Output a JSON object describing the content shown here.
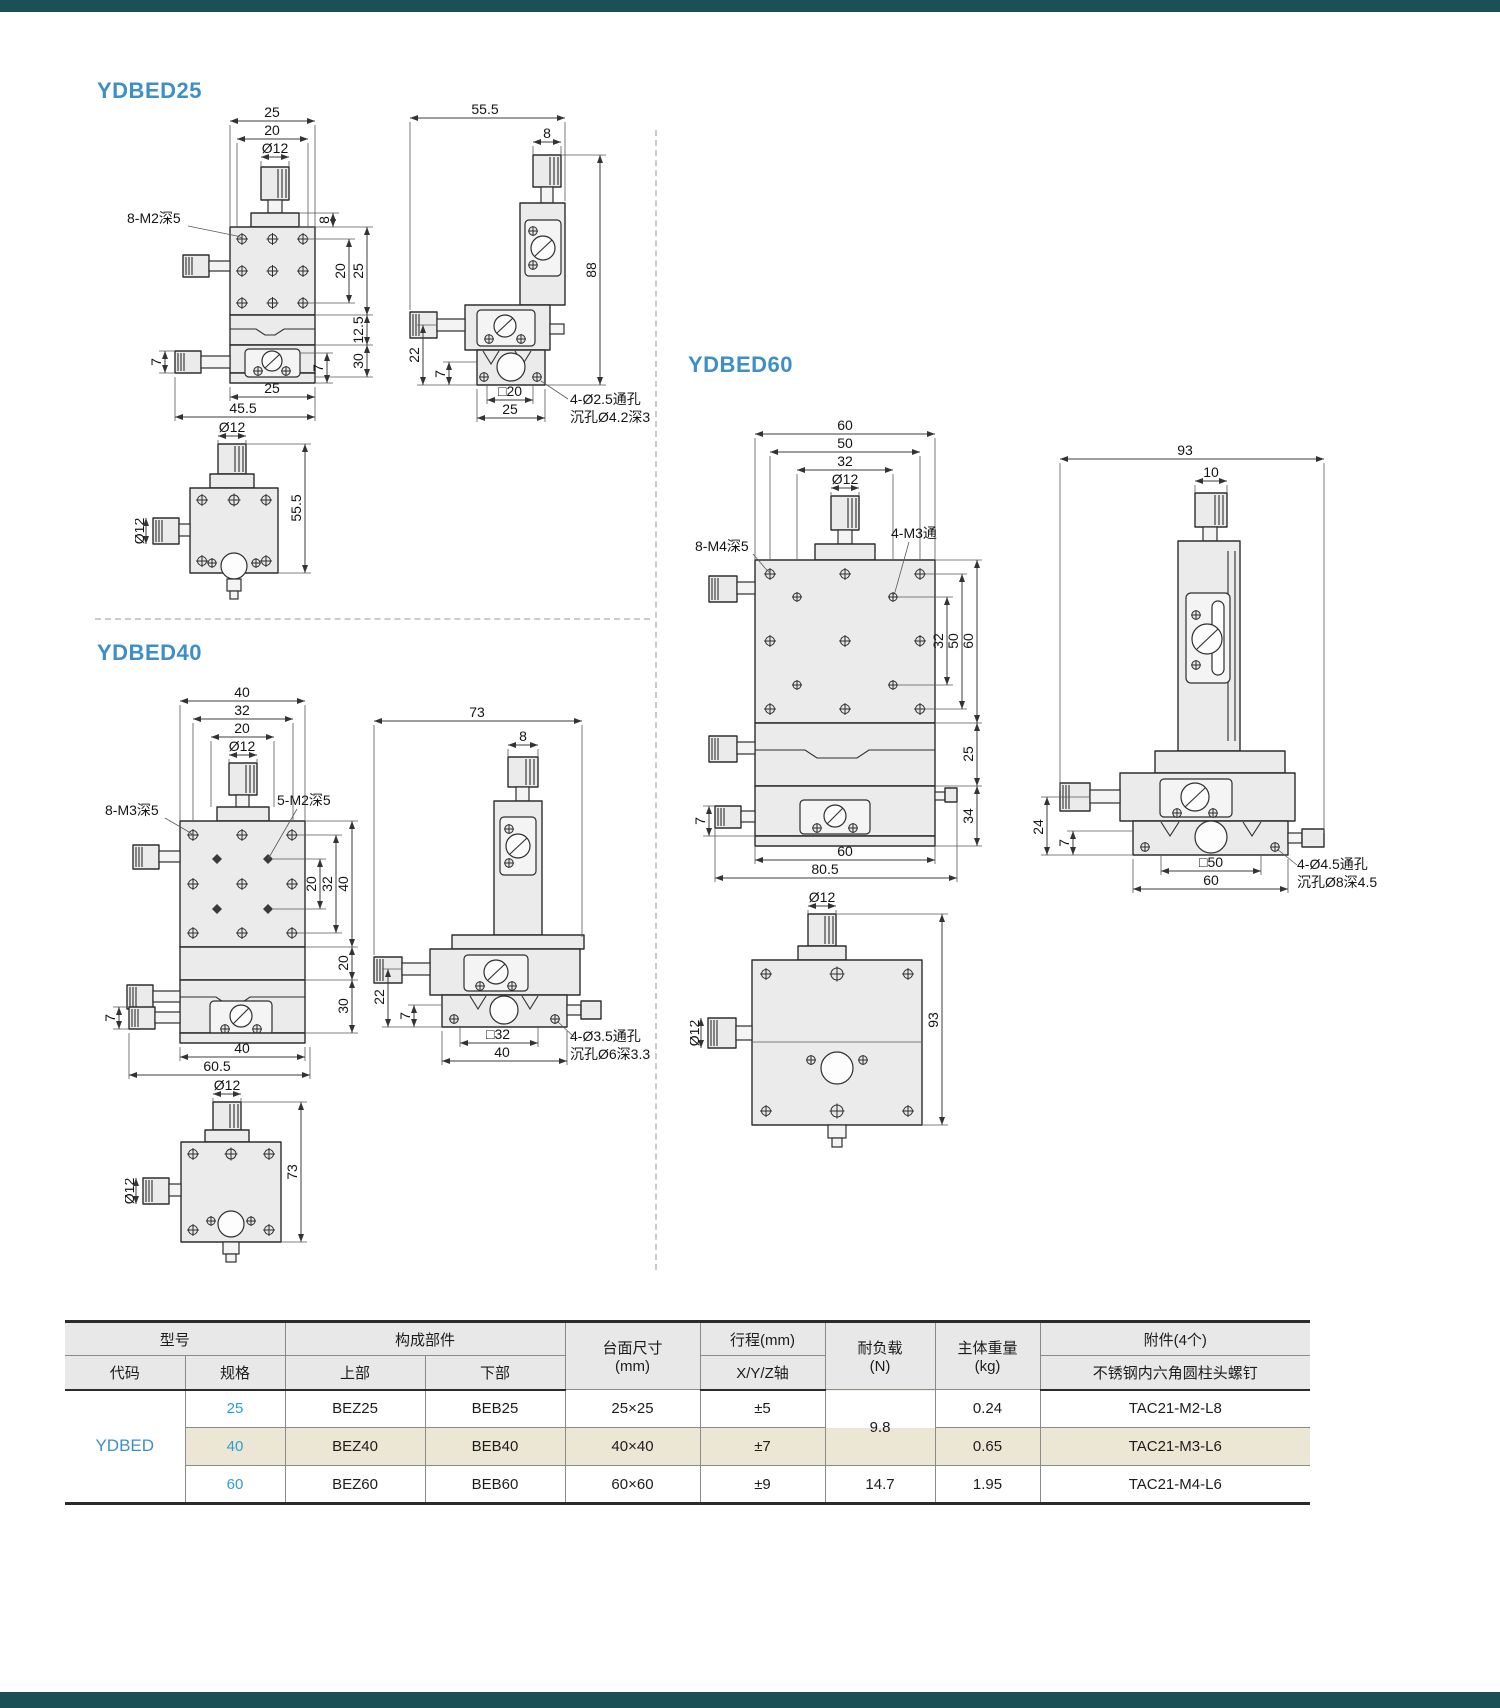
{
  "page": {
    "top_bar_color": "#1B5156",
    "bottom_bar_color": "#1B5156",
    "accent_blue": "#3E8FC7",
    "spec_blue": "#2B9FD0",
    "highlight_beige": "#ECE6D4"
  },
  "sections": {
    "d25": {
      "title": "YDBED25",
      "front": {
        "w_outer": "25",
        "w_inner": "20",
        "knob_dia": "Ø12",
        "note_thread": "8-M2深5",
        "h_collar": "8",
        "h_holes": "20",
        "h_body": "25",
        "h_mid": "12.5",
        "h_lower": "30",
        "h_knob": "7",
        "h_base": "7",
        "w_body": "25",
        "w_total": "45.5"
      },
      "side": {
        "w_total": "55.5",
        "w_knob": "8",
        "h_total": "88",
        "h_stage": "22",
        "h_plate": "7",
        "sq_base": "□20",
        "w_plate": "25",
        "note_hole1": "4-Ø2.5通孔",
        "note_hole2": "沉孔Ø4.2深3"
      },
      "top": {
        "knob_dia": "Ø12",
        "side_knob_dia": "Ø12",
        "h_total": "55.5"
      }
    },
    "d40": {
      "title": "YDBED40",
      "front": {
        "w_outer": "40",
        "w_mid": "32",
        "w_inner": "20",
        "knob_dia": "Ø12",
        "note_thread": "8-M3深5",
        "note_thread2": "5-M2深5",
        "h_inner": "20",
        "h_holes": "32",
        "h_body": "40",
        "h_mid": "20",
        "h_lower": "30",
        "h_knob": "7",
        "w_body": "40",
        "w_total": "60.5"
      },
      "side": {
        "w_total": "73",
        "w_knob": "8",
        "h_stage": "22",
        "h_plate": "7",
        "sq_base": "□32",
        "w_plate": "40",
        "note_hole1": "4-Ø3.5通孔",
        "note_hole2": "沉孔Ø6深3.3"
      },
      "top": {
        "knob_dia": "Ø12",
        "side_knob_dia": "Ø12",
        "h_total": "73"
      }
    },
    "d60": {
      "title": "YDBED60",
      "front": {
        "w_outer": "60",
        "w_mid": "50",
        "w_inner": "32",
        "knob_dia": "Ø12",
        "note_thread": "8-M4深5",
        "note_thread2": "4-M3通",
        "h_inner": "32",
        "h_holes": "50",
        "h_body": "60",
        "h_mid": "25",
        "h_lower": "34",
        "h_knob": "7",
        "w_body": "60",
        "w_total": "80.5"
      },
      "side": {
        "w_total": "93",
        "w_knob": "10",
        "h_stage": "24",
        "h_plate": "7",
        "sq_base": "□50",
        "w_plate": "60",
        "note_hole1": "4-Ø4.5通孔",
        "note_hole2": "沉孔Ø8深4.5"
      },
      "top": {
        "knob_dia": "Ø12",
        "side_knob_dia": "Ø12",
        "h_total": "93"
      }
    }
  },
  "table": {
    "headers": {
      "model": "型号",
      "code": "代码",
      "spec": "规格",
      "components": "构成部件",
      "upper": "上部",
      "lower": "下部",
      "surface": "台面尺寸",
      "surface_unit": "(mm)",
      "travel": "行程(mm)",
      "travel_axis": "X/Y/Z轴",
      "load": "耐负载",
      "load_unit": "(N)",
      "weight": "主体重量",
      "weight_unit": "(kg)",
      "accessory": "附件(4个)",
      "accessory_sub": "不锈钢内六角圆柱头螺钉"
    },
    "code_value": "YDBED",
    "load_shared": "9.8",
    "rows": [
      {
        "spec": "25",
        "upper": "BEZ25",
        "lower": "BEB25",
        "surface": "25×25",
        "travel": "±5",
        "weight": "0.24",
        "accessory": "TAC21-M2-L8"
      },
      {
        "spec": "40",
        "upper": "BEZ40",
        "lower": "BEB40",
        "surface": "40×40",
        "travel": "±7",
        "weight": "0.65",
        "accessory": "TAC21-M3-L6"
      },
      {
        "spec": "60",
        "upper": "BEZ60",
        "lower": "BEB60",
        "surface": "60×60",
        "travel": "±9",
        "load": "14.7",
        "weight": "1.95",
        "accessory": "TAC21-M4-L6"
      }
    ]
  }
}
